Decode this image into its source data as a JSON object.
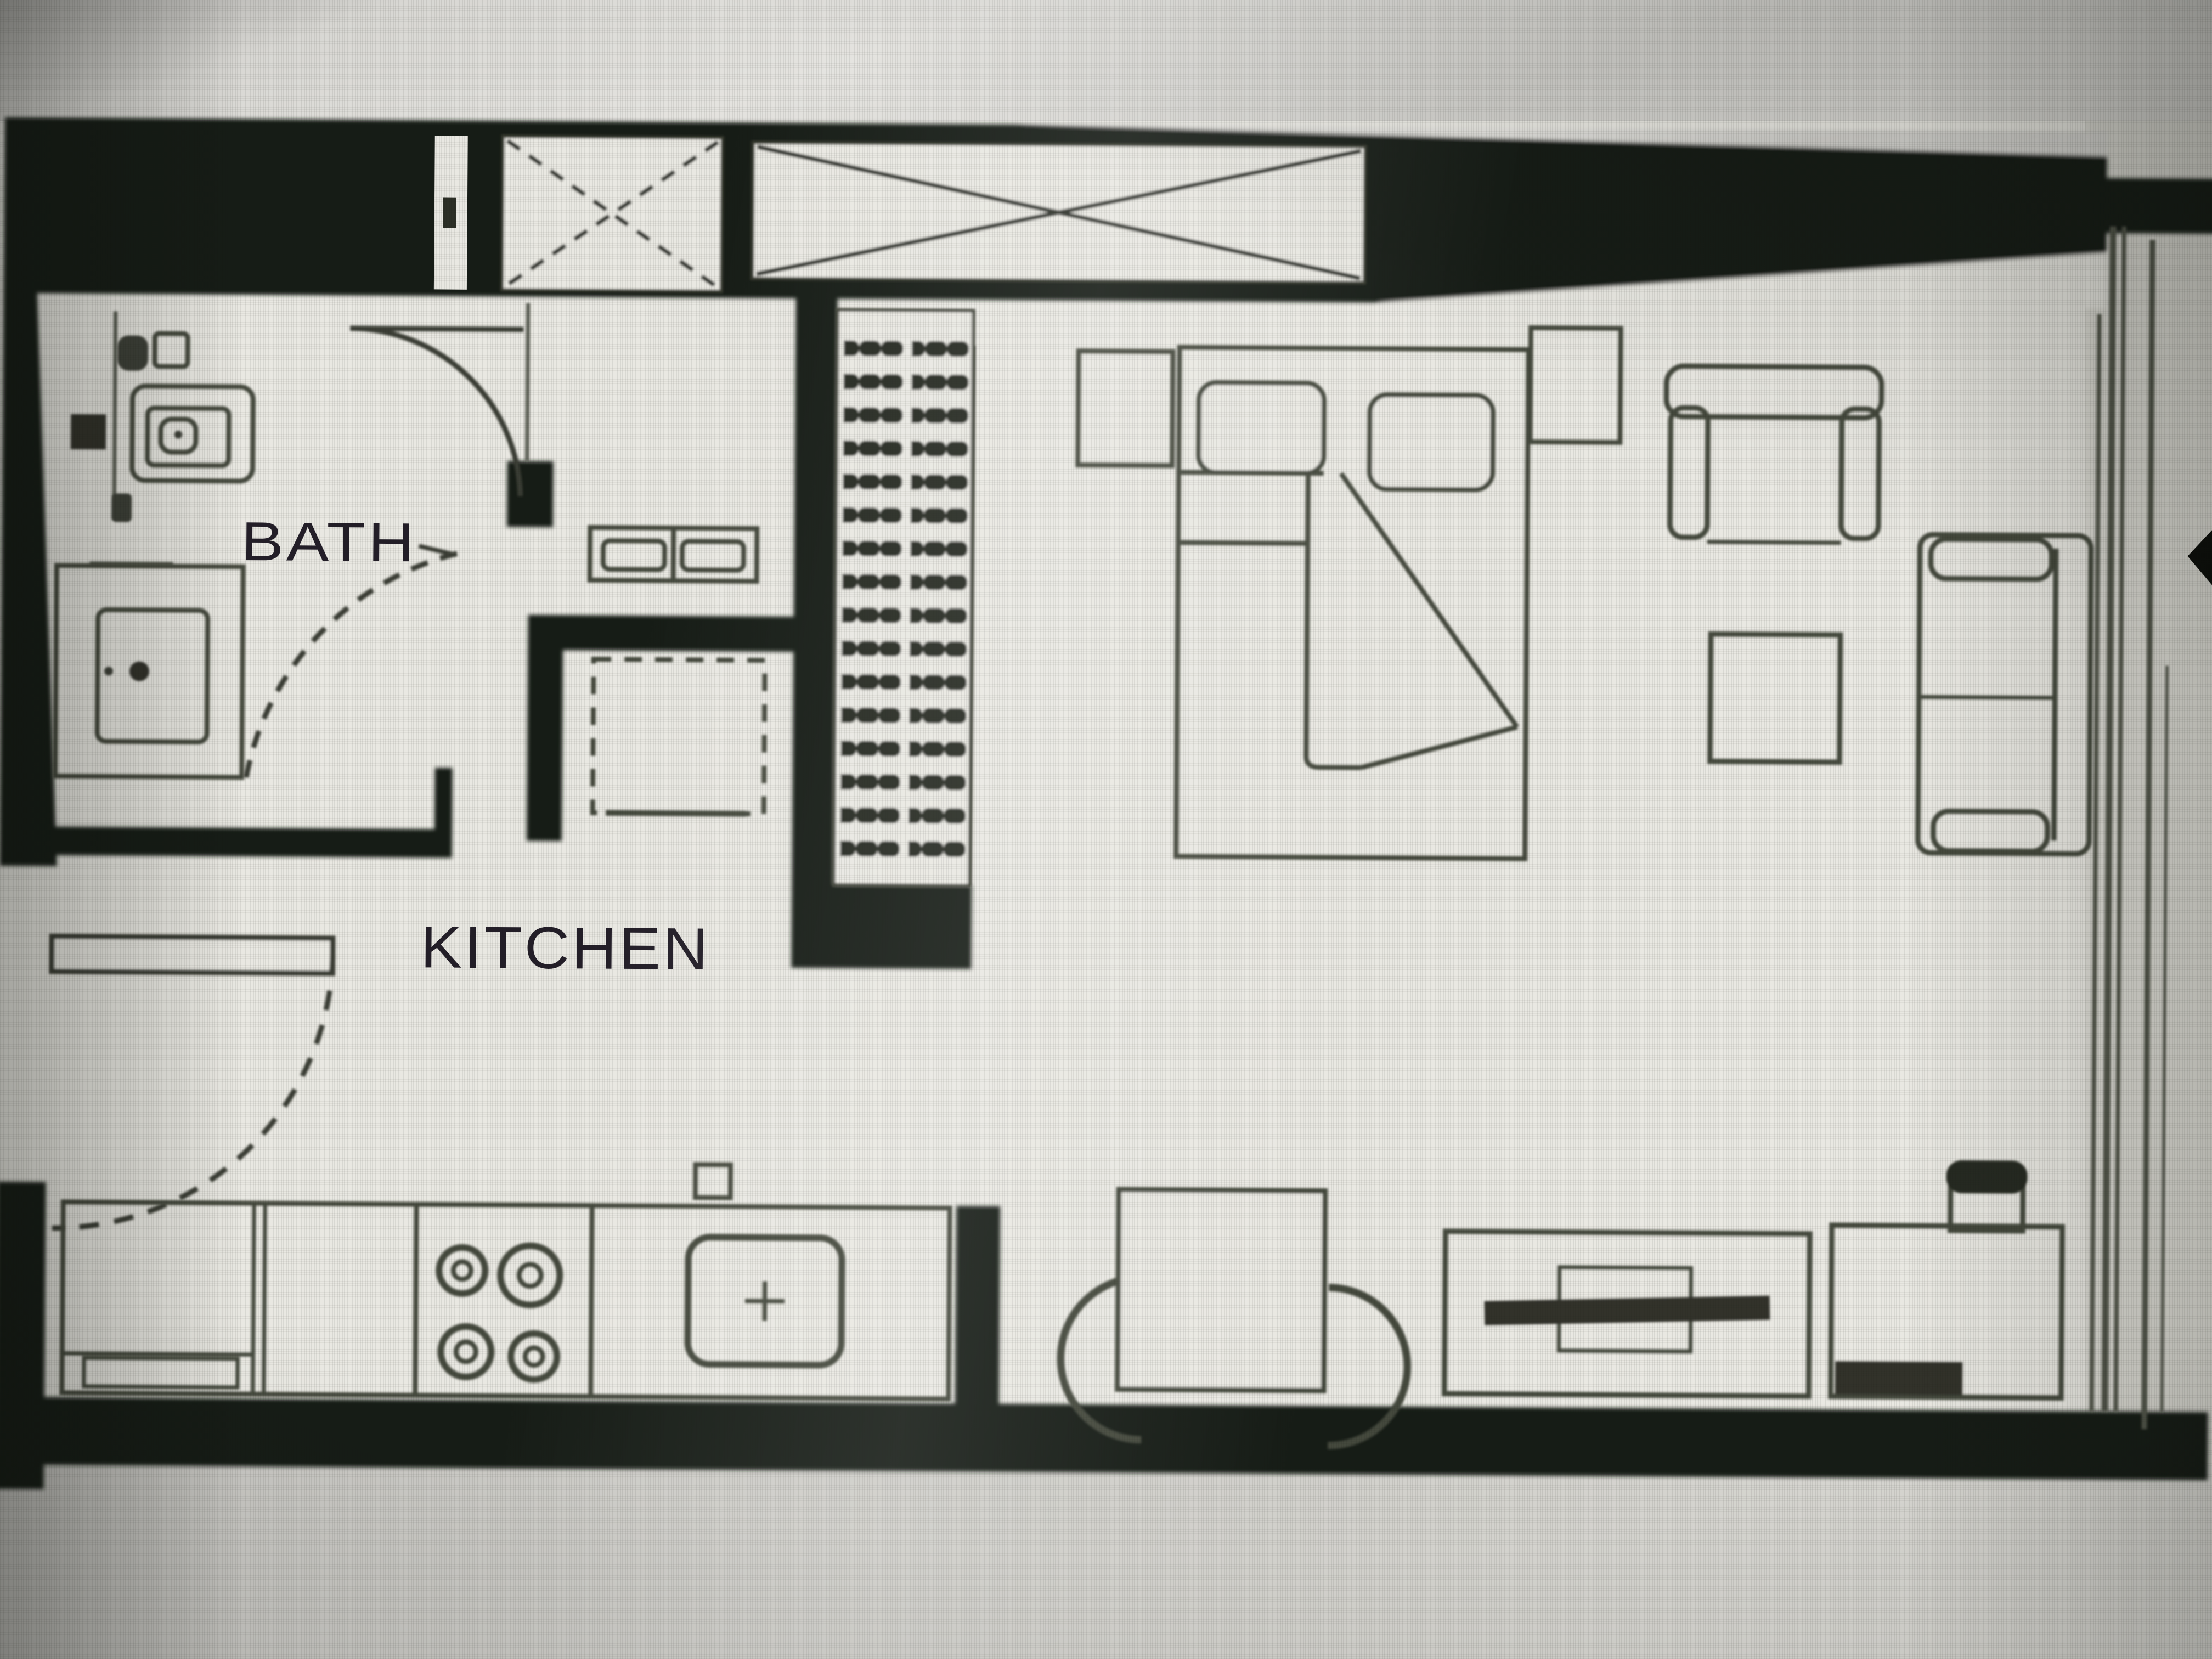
{
  "labels": {
    "bath": "BATH",
    "kitchen": "KITCHEN"
  },
  "colors": {
    "wall": "#161a12",
    "furniture_line": "#45483e",
    "paper": "#e9e8e2",
    "backdrop": "#d2d1cd",
    "label_text": "#231e28"
  },
  "fixtures": [
    "vent-slot",
    "window-cross-small",
    "window-cross-long",
    "toilet",
    "bathroom-vanity-sink",
    "wall-mounted-box",
    "shower-tray",
    "bath-door-swing",
    "hall-door-swing-dashed",
    "entry-door-leaf",
    "entry-door-swing-dashed",
    "wardrobe-hangers",
    "dresser-unit",
    "appliance-dashed-box",
    "kitchen-counter",
    "cooktop-4-burners",
    "kitchen-sink-basin",
    "wall-switch-box",
    "dining-chair-left",
    "dining-table",
    "dining-chair-right",
    "tv-console",
    "tv-bar",
    "sideboard",
    "kettle-on-sideboard",
    "nightstand-left",
    "double-bed",
    "pillow-left",
    "pillow-right",
    "duvet-fold",
    "nightstand-right",
    "armchair",
    "side-table",
    "sofa",
    "page-edge-lines",
    "cursor-arrow"
  ]
}
